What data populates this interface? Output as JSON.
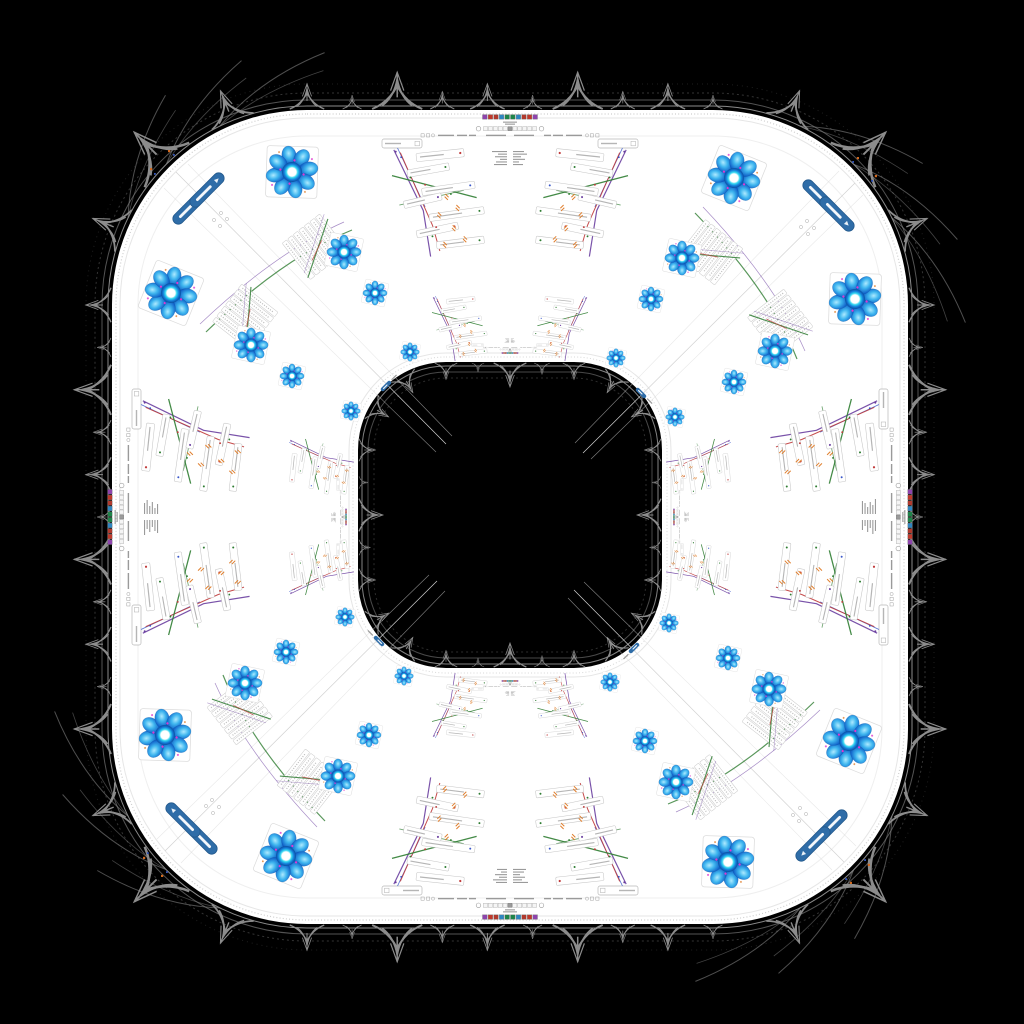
{
  "scene": {
    "type": "kaleidoscope-warped-ui-screenshot",
    "canvas": {
      "w": 1024,
      "h": 1024,
      "background": "#000000"
    },
    "ring": {
      "fill": "#ffffff",
      "outer": {
        "x": 112,
        "y": 110,
        "w": 796,
        "h": 814,
        "r": 195
      },
      "hole": {
        "x": 358,
        "y": 362,
        "w": 304,
        "h": 306,
        "r": 88
      },
      "fringe_color": "#8c8c8c"
    },
    "symmetry": {
      "edges": 4,
      "corners": 4,
      "mirrored": true
    }
  },
  "palette": {
    "accent_blue_button": "#2f6da8",
    "button_border": "#23598c",
    "petal_core": "#aeeaff",
    "petal_mid": "#3fb6ef",
    "petal_deep": "#1060c8",
    "petal_edge": "#0a3f92",
    "ring_inner": "#ffffff",
    "ring_cyan": "#2fd4f0",
    "ring_blue": "#1479d8",
    "ring_edge": "#0b4fa0",
    "magenta_dot": "#e03ad0",
    "line_green": "#2f7d32",
    "line_red": "#c03a3a",
    "line_purple": "#6a3fa0",
    "line_blue": "#3a57c9",
    "slash_orange": "#e08030",
    "card_border": "#c6c6c6",
    "seam": "#d2d2d2",
    "fringe": "#8c8c8c",
    "speck_orange": "#d2691e",
    "speck_blue": "#3355bb"
  },
  "toolbar": {
    "icon_colors": [
      "#8e44ad",
      "#c0392b",
      "#b03a2e",
      "#2e86c1",
      "#1e8449",
      "#1e8449",
      "#2e86c1",
      "#b03a2e",
      "#c0392b",
      "#8e44ad"
    ],
    "filmstrip_count": 11,
    "input_count": 2,
    "instances": 4,
    "mini_instances": 4
  },
  "components": {
    "flower": "orbital-density-flower",
    "button": "blue-pill-button",
    "pill": "mini-blue-pill",
    "fan": "annotation-card-fan",
    "stack": "list-card-stack",
    "toolbar": "mirrored-toolbar",
    "tooth": "lace-fringe-tooth"
  },
  "counts": {
    "flowers_per_corner": 8,
    "buttons_per_corner": 2,
    "fans_per_edge": 4,
    "stacks_per_corner": 2
  },
  "text_note": "all embedded text is below legibility at source resolution"
}
